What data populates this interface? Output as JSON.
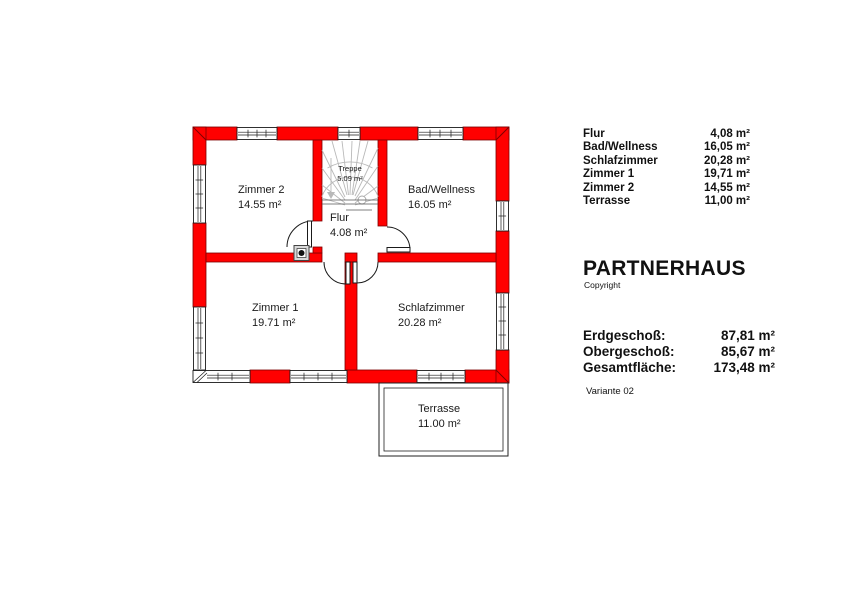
{
  "plan": {
    "wall_color": "#ff0000",
    "rooms": [
      {
        "id": "zimmer2",
        "name": "Zimmer 2",
        "area": "14.55 m²"
      },
      {
        "id": "treppe",
        "name": "Treppe",
        "area": "5.09 m²"
      },
      {
        "id": "flur",
        "name": "Flur",
        "area": "4.08 m²"
      },
      {
        "id": "bad-wellness",
        "name": "Bad/Wellness",
        "area": "16.05 m²"
      },
      {
        "id": "zimmer1",
        "name": "Zimmer 1",
        "area": "19.71 m²"
      },
      {
        "id": "schlafzimmer",
        "name": "Schlafzimmer",
        "area": "20.28 m²"
      },
      {
        "id": "terrasse",
        "name": "Terrasse",
        "area": "11.00 m²"
      }
    ]
  },
  "legend": {
    "rows": [
      {
        "label": "Flur",
        "value": "4,08 m²"
      },
      {
        "label": "Bad/Wellness",
        "value": "16,05 m²"
      },
      {
        "label": "Schlafzimmer",
        "value": "20,28 m²"
      },
      {
        "label": "Zimmer 1",
        "value": "19,71 m²"
      },
      {
        "label": "Zimmer 2",
        "value": "14,55 m²"
      },
      {
        "label": "Terrasse",
        "value": "11,00 m²"
      }
    ]
  },
  "brand": {
    "title": "PARTNERHAUS",
    "subtitle": "Copyright"
  },
  "totals": {
    "rows": [
      {
        "label": "Erdgeschoß:",
        "value": "87,81 m²"
      },
      {
        "label": "Obergeschoß:",
        "value": "85,67 m²"
      },
      {
        "label": "Gesamtfläche:",
        "value": "173,48 m²"
      }
    ],
    "variant": "Variante 02"
  }
}
